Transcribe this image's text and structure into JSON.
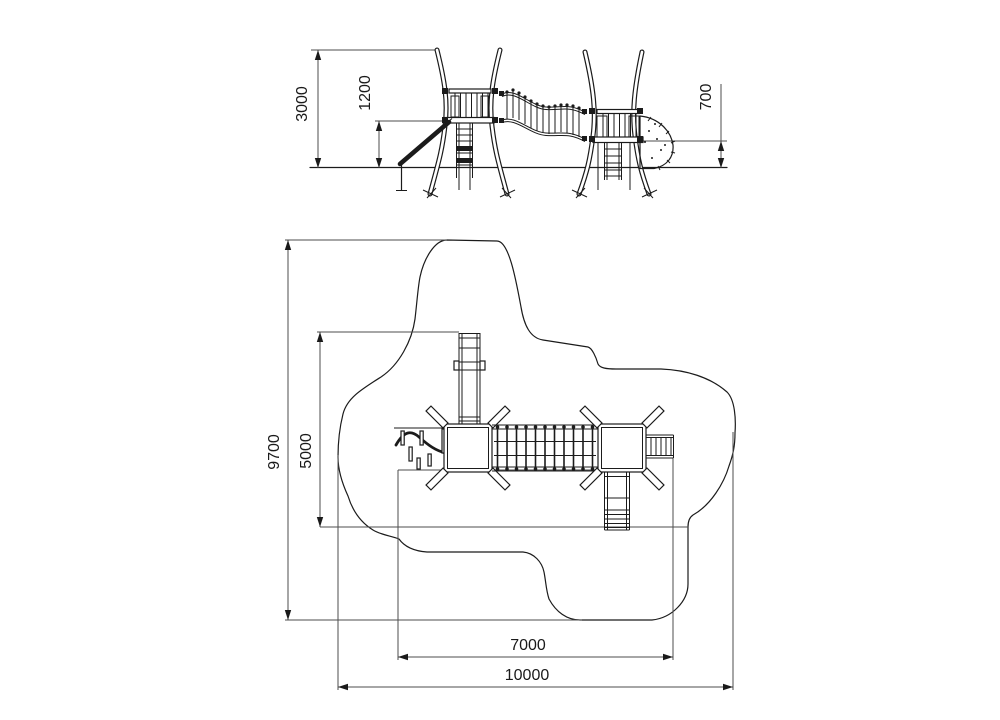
{
  "drawing_type": "playground equipment technical drawing, side elevation and plan view with safety zone",
  "dimensions": {
    "elevation": {
      "overall_height": "3000",
      "main_deck_height": "1200",
      "low_deck_height": "700"
    },
    "plan": {
      "zone_depth": "9700",
      "equipment_depth": "5000",
      "equipment_width": "7000",
      "zone_width": "10000"
    }
  },
  "colors": {
    "background": "#ffffff",
    "structure_line": "#1b1b1b",
    "dimension_line": "#4d4d4d",
    "text": "#1a1a1a"
  }
}
